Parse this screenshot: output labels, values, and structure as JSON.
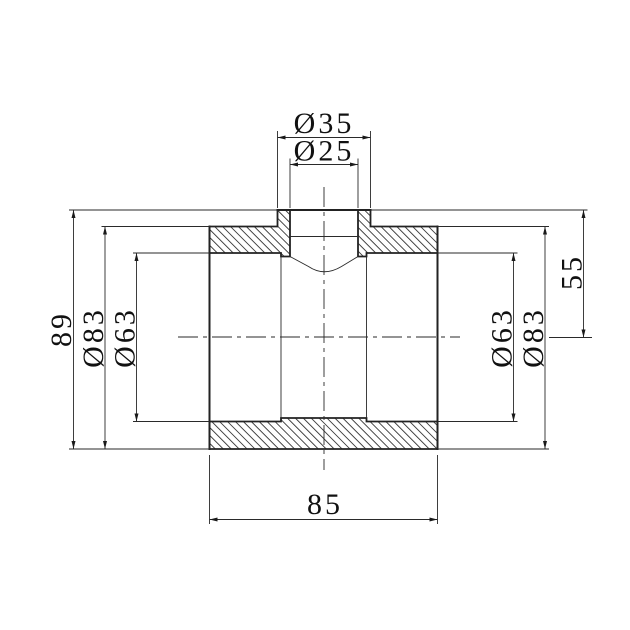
{
  "drawing": {
    "type": "technical-section-drawing",
    "subject": "pipe-tee-fitting",
    "colors": {
      "background": "#ffffff",
      "line": "#222222",
      "text": "#111111"
    },
    "dimensions": {
      "branch_outer_diameter": "Ø35",
      "branch_inner_diameter": "Ø25",
      "overall_height": "89",
      "body_outer_diameter_left": "Ø83",
      "socket_inner_diameter_left": "Ø63",
      "socket_inner_diameter_right": "Ø63",
      "body_outer_diameter_right": "Ø83",
      "branch_top_to_axis": "55",
      "body_length": "85"
    }
  }
}
